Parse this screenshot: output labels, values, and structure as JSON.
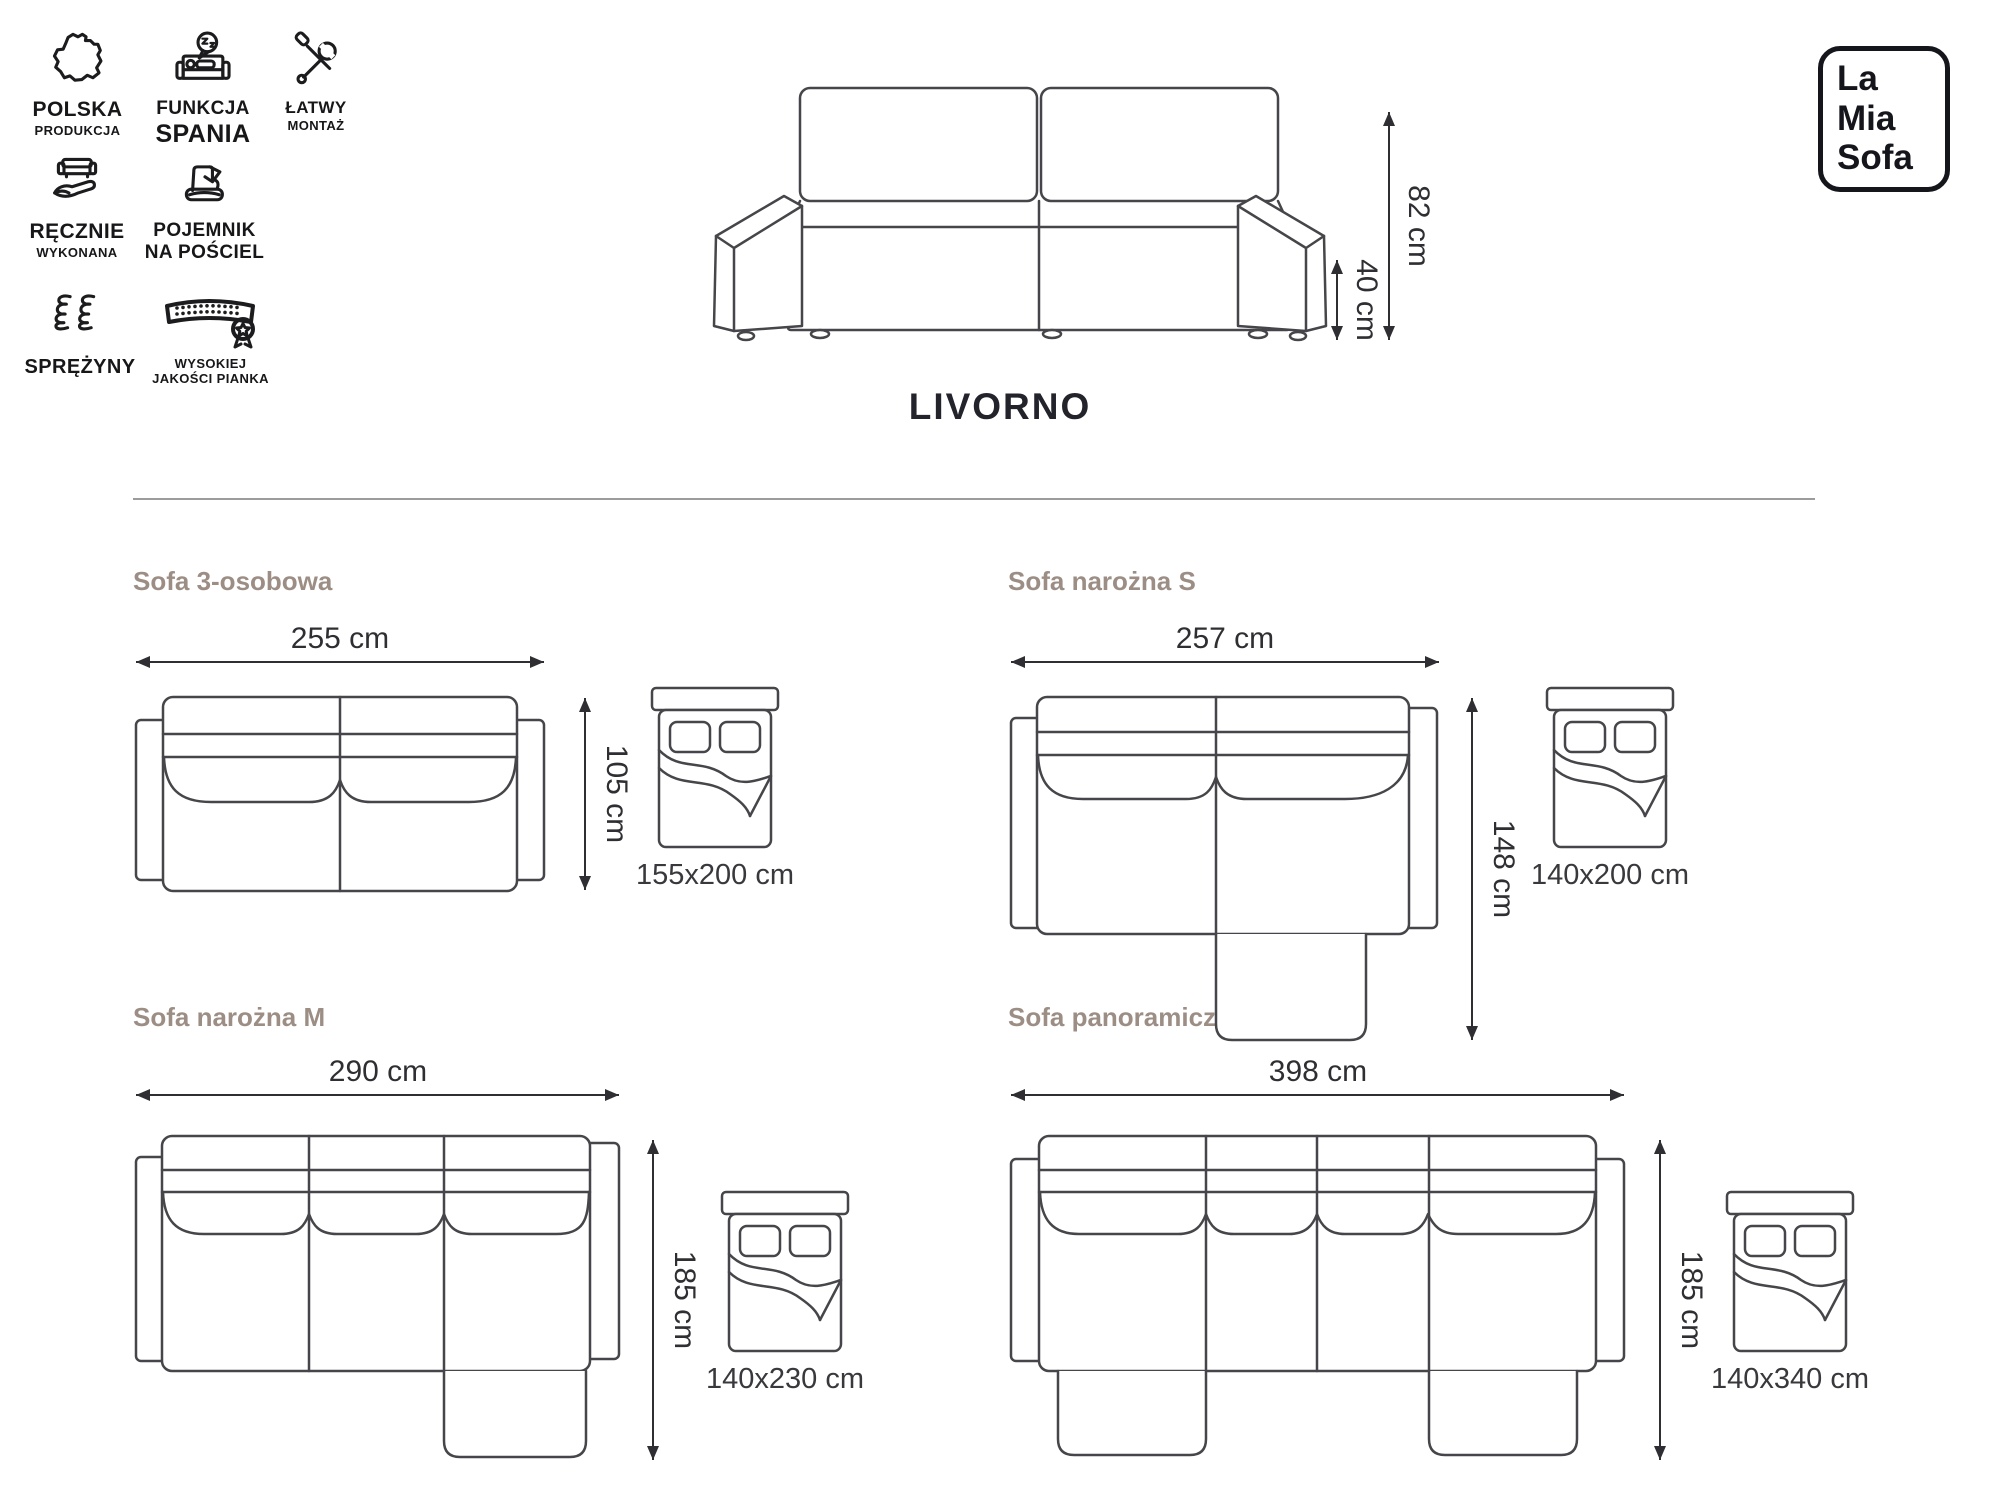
{
  "page": {
    "title": "LIVORNO"
  },
  "brand": {
    "line1": "La",
    "line2": "Mia",
    "line3": "Sofa"
  },
  "front_view": {
    "height": "82 cm",
    "seat_height": "40 cm"
  },
  "features": [
    {
      "icon": "poland-map-icon",
      "line1": "POLSKA",
      "line2": "PRODUKCJA"
    },
    {
      "icon": "sleep-function-icon",
      "line1": "FUNKCJA",
      "line2": "SPANIA"
    },
    {
      "icon": "easy-assembly-icon",
      "line1": "ŁATWY",
      "line2": "MONTAŻ"
    },
    {
      "icon": "handmade-icon",
      "line1": "RĘCZNIE",
      "line2": "WYKONANA"
    },
    {
      "icon": "bedding-storage-icon",
      "line1": "POJEMNIK",
      "line2": "NA POŚCIEL"
    },
    {
      "icon": "springs-icon",
      "line1": "SPRĘŻYNY",
      "line2": ""
    },
    {
      "icon": "foam-quality-icon",
      "line1": "WYSOKIEJ",
      "line2": "JAKOŚCI PIANKA"
    }
  ],
  "variants": [
    {
      "name": "Sofa 3-osobowa",
      "width": "255 cm",
      "depth": "105 cm",
      "bed_size": "155x200 cm"
    },
    {
      "name": "Sofa narożna S",
      "width": "257 cm",
      "depth": "148 cm",
      "bed_size": "140x200 cm"
    },
    {
      "name": "Sofa narożna M",
      "width": "290 cm",
      "depth": "185 cm",
      "bed_size": "140x230 cm"
    },
    {
      "name": "Sofa panoramiczna",
      "width": "398 cm",
      "depth": "185 cm",
      "bed_size": "140x340 cm"
    }
  ],
  "colors": {
    "accent_heading": "#9c8e85",
    "line_art": "#46464a",
    "dimension_text": "#2f2f33",
    "icon": "#1c1c1e",
    "divider": "#9c9c9c"
  }
}
